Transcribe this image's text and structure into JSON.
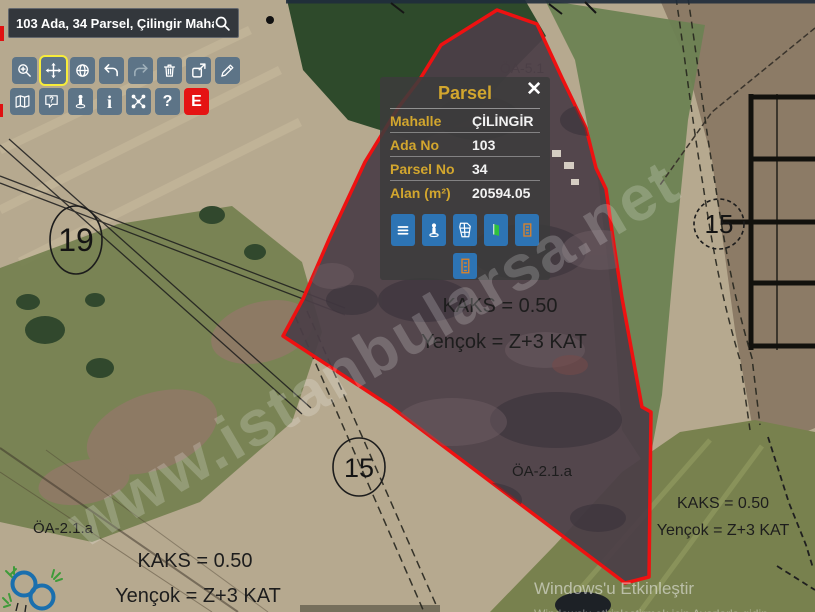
{
  "search": {
    "value": "103 Ada, 34 Parsel, Çilingir Mahallesi"
  },
  "toolbar": {
    "row1": [
      {
        "name": "zoom-in"
      },
      {
        "name": "pan",
        "active": true
      },
      {
        "name": "world"
      },
      {
        "name": "undo"
      },
      {
        "name": "redo",
        "disabled": true
      },
      {
        "name": "delete"
      },
      {
        "name": "export"
      },
      {
        "name": "draw"
      }
    ],
    "row2": [
      {
        "name": "layers-map"
      },
      {
        "name": "help-bubble",
        "glyph": "?"
      },
      {
        "name": "street-view"
      },
      {
        "name": "info",
        "glyph": "i"
      },
      {
        "name": "measure-network"
      },
      {
        "name": "question",
        "glyph": "?"
      },
      {
        "name": "emlak",
        "glyph": "E",
        "color": "#e51313"
      }
    ],
    "button_color": "#5d7487",
    "active_border": "#f7ec3a"
  },
  "popup": {
    "title": "Parsel",
    "close_glyph": "✕",
    "rows": [
      {
        "label": "Mahalle",
        "value": "ÇİLİNGİR"
      },
      {
        "label": "Ada No",
        "value": "103"
      },
      {
        "label": "Parsel No",
        "value": "34"
      },
      {
        "label": "Alan (m²)",
        "value": "20594.05"
      }
    ],
    "buttons": [
      "details-list",
      "street-view-person",
      "map-3d",
      "door-exit",
      "building-report",
      "building-report-2"
    ],
    "accent_gold": "#d2a62e",
    "button_blue": "#2d74b4"
  },
  "map": {
    "watermark": "www.istanbularsa.net",
    "parcel_outline_color": "#ee1111",
    "labels": {
      "oa51_partial": "ÖA-5.1",
      "center_kaks": "KAKS = 0.50",
      "center_yencok": "Yençok = Z+3 KAT",
      "right_oa": "ÖA-2.1.a",
      "right_kaks": "KAKS = 0.50",
      "right_yencok": "Yençok = Z+3 KAT",
      "left_oa": "ÖA-2.1.a",
      "left_kaks": "KAKS = 0.50",
      "left_yencok": "Yençok = Z+3 KAT"
    },
    "parcel_circles": [
      {
        "number": "19"
      },
      {
        "number": "15"
      },
      {
        "number": "15"
      }
    ]
  },
  "os": {
    "activate_line1": "Windows'u Etkinleştir",
    "activate_line2": "Windows'u etkinleştirmek için Ayarlar'a gidin."
  }
}
